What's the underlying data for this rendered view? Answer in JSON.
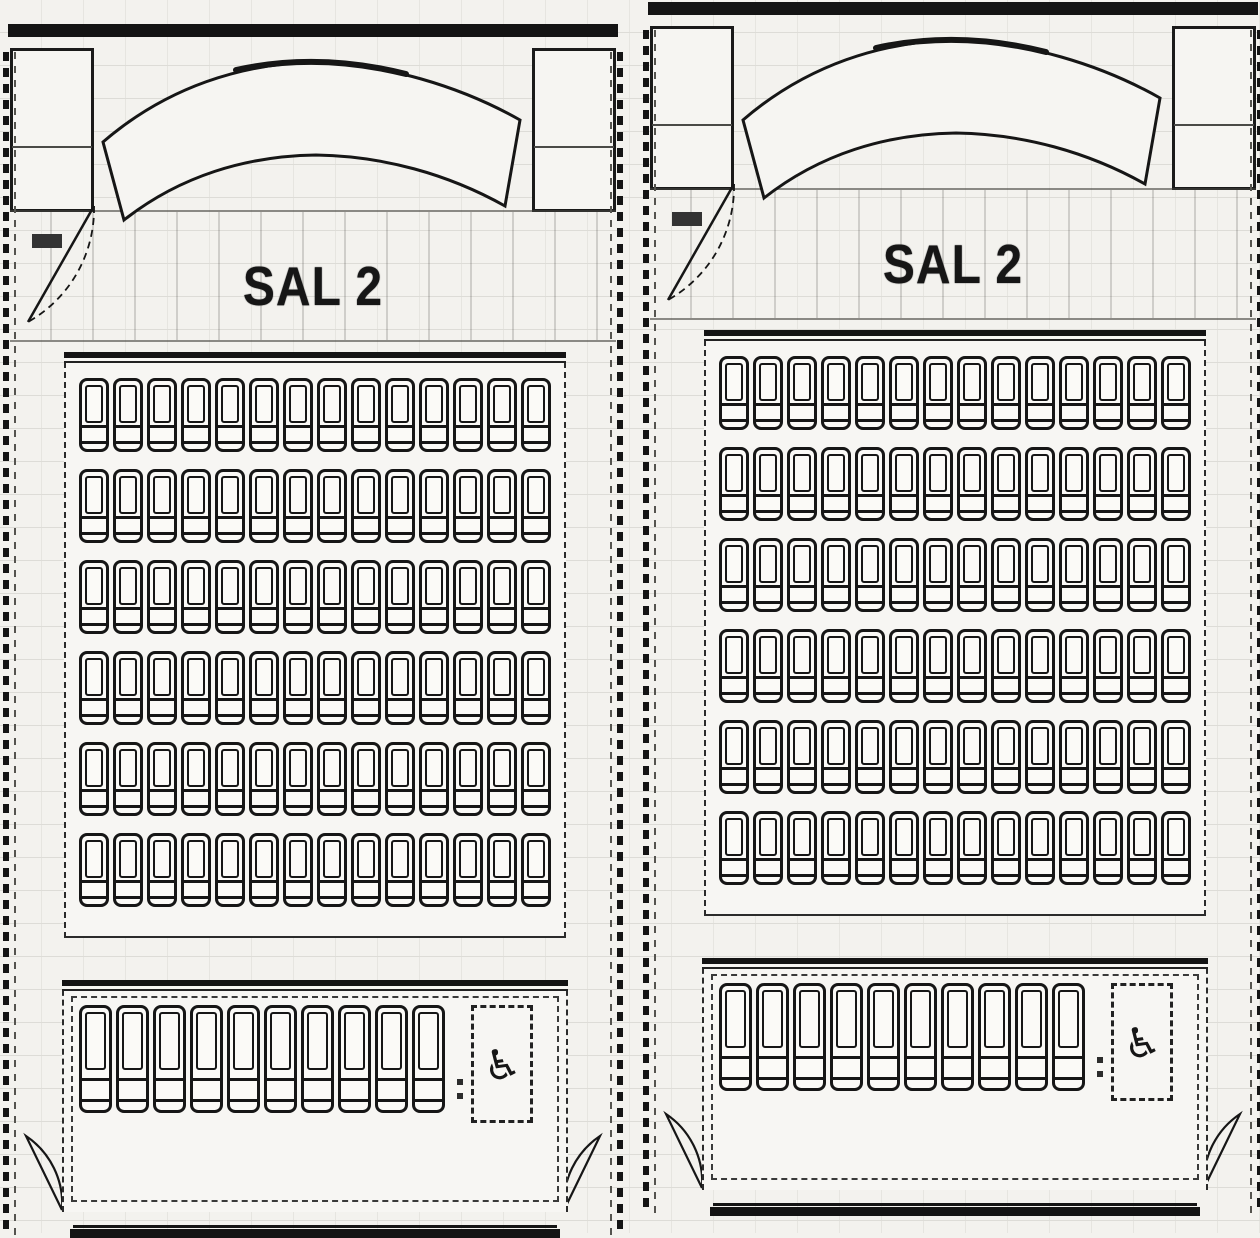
{
  "page": {
    "background": "#f3f2ee",
    "line_color": "#141414",
    "grid_color": "#dddcd7",
    "description_visible_text_only": true
  },
  "panels": [
    {
      "side": "left",
      "hall_label": "SAL 2",
      "wheelchair_icon": "♿",
      "seating": {
        "main_rows": 6,
        "seats_per_row": 14,
        "front_row_seats": 10,
        "wheelchair_spaces": 1
      }
    },
    {
      "side": "right",
      "hall_label": "SAL 2",
      "wheelchair_icon": "♿",
      "seating": {
        "main_rows": 6,
        "seats_per_row": 14,
        "front_row_seats": 10,
        "wheelchair_spaces": 1
      }
    }
  ]
}
